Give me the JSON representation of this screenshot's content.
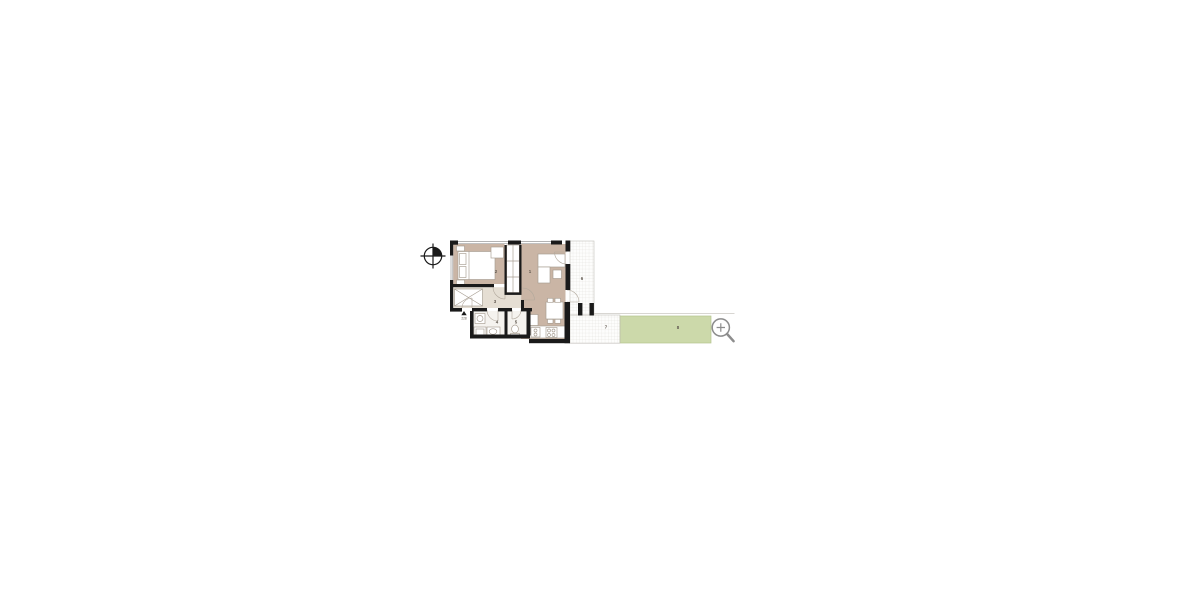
{
  "scene": {
    "background": "#ffffff"
  },
  "floor_plan": {
    "rooms": [
      {
        "name": "living-room",
        "label": "1"
      },
      {
        "name": "bedroom",
        "label": "2"
      },
      {
        "name": "hall",
        "label": "3"
      },
      {
        "name": "bathroom",
        "label": "4"
      },
      {
        "name": "wc",
        "label": "5"
      },
      {
        "name": "balcony",
        "label": "6"
      },
      {
        "name": "terrace",
        "label": "7"
      },
      {
        "name": "garden",
        "label": "8"
      }
    ],
    "entrance": {
      "label": "228"
    },
    "colors": {
      "wall": "#1a1a1a",
      "floor_main": "#cab5a5",
      "floor_hall": "#e5ded3",
      "floor_wet": "#f5f3ef",
      "floor_tile": "#fdfdfc",
      "garden_fill": "#ccd9aa",
      "garden_stroke": "#b5c48f",
      "tile_grid": "#e0ddd8",
      "outline": "#c2beb8",
      "furniture_stroke": "#a79d91",
      "door_stroke": "#b1a89c",
      "window_stroke": "#9a9a9a",
      "label_color": "#5f574e",
      "icon_grey": "#8d8d8d",
      "compass": "#1a1a1a"
    }
  }
}
